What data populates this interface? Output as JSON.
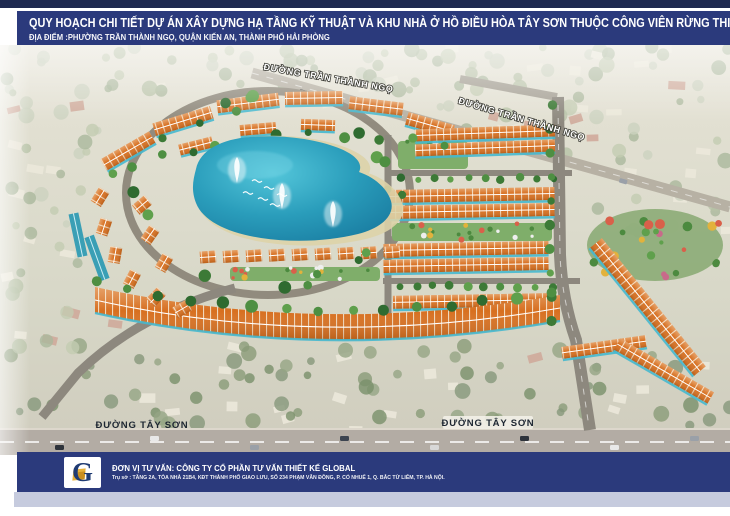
{
  "header": {
    "title": "QUY HOẠCH CHI TIẾT DỰ ÁN XÂY DỰNG HẠ TẦNG KỸ THUẬT VÀ KHU NHÀ Ở HỒ ĐIỀU HÒA TÂY SƠN THUỘC CÔNG VIÊN RỪNG THIÊN VĂN, TỶ LỆ 1/500",
    "location": "ĐỊA ĐIỂM :PHƯỜNG TRẦN THÀNH NGỌ, QUẬN KIẾN AN, THÀNH PHỐ HẢI PHÒNG"
  },
  "aerial": {
    "road_labels": {
      "tran_thanh_ngo": "ĐƯỜNG TRẦN THÀNH NGỌ",
      "tay_son": "ĐƯỜNG TÂY SƠN"
    }
  },
  "footer": {
    "logo_letter": "G",
    "consultant": "ĐƠN VỊ TƯ VẤN: CÔNG TY CỔ PHẦN TƯ VẤN THIẾT KẾ GLOBAL",
    "address": "Trụ sở : TẦNG 2A, TÒA NHÀ 21B4, KĐT THÀNH PHỐ GIAO LƯU, SỐ 234 PHẠM VĂN ĐỒNG, P. CỔ NHUẾ 1, Q. BẮC TỪ LIÊM, TP. HÀ NỘI."
  },
  "colors": {
    "banner_navy": "#2b3a7c",
    "top_strip_navy": "#1e2950",
    "lavender_strip": "#c6cbde",
    "roof_orange": "#d76f1f",
    "lake_teal": "#2a9dbb",
    "road_gray": "#8d887e"
  }
}
